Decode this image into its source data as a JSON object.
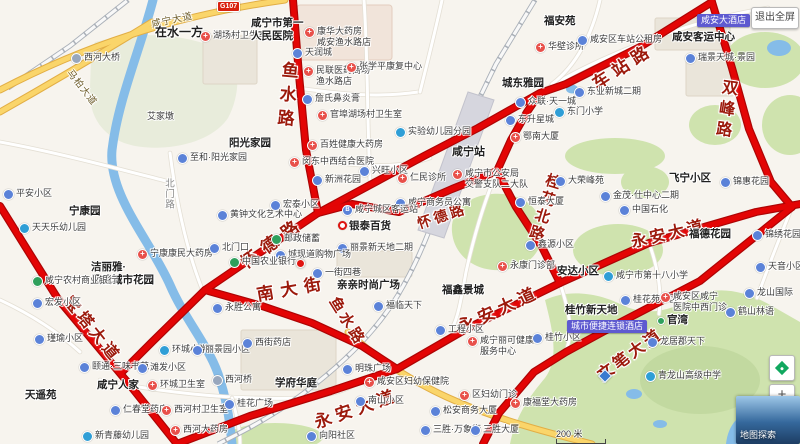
{
  "palette": {
    "route_red": "#e30505",
    "route_edge": "#ad0404",
    "water": "#85bce8",
    "green": "#cfe3ae",
    "road_yellow": "#fad56a",
    "red_label": "#9c1a0c",
    "ad_purple": "#5e5ad0"
  },
  "ui": {
    "fullscreen": "退出全屏",
    "zoom_in": "+",
    "zoom_out": "−",
    "explore": "地图探索",
    "scale": "200 米"
  },
  "map": {
    "shield": "G107",
    "red_roads": [
      {
        "t": "鱼水路",
        "x": 286,
        "y": 97,
        "v": 1,
        "rot": 5,
        "size": 17,
        "sp": 7
      },
      {
        "t": "车站路",
        "x": 622,
        "y": 65,
        "v": 0,
        "rot": -33,
        "size": 17,
        "sp": 6
      },
      {
        "t": "双峰路",
        "x": 724,
        "y": 110,
        "v": 1,
        "rot": 8,
        "size": 16,
        "sp": 5
      },
      {
        "t": "怀德路",
        "x": 272,
        "y": 241,
        "v": 0,
        "rot": -36,
        "size": 17,
        "sp": 8
      },
      {
        "t": "怀德路",
        "x": 442,
        "y": 216,
        "v": 0,
        "rot": -18,
        "size": 14,
        "sp": 3
      },
      {
        "t": "桂花北路",
        "x": 544,
        "y": 208,
        "v": 1,
        "rot": 17,
        "size": 15,
        "sp": 3
      },
      {
        "t": "南大街",
        "x": 292,
        "y": 287,
        "v": 0,
        "rot": -10,
        "size": 17,
        "sp": 7
      },
      {
        "t": "鱼水路",
        "x": 348,
        "y": 321,
        "v": 0,
        "rot": 58,
        "size": 15,
        "sp": 3
      },
      {
        "t": "永安大道",
        "x": 498,
        "y": 308,
        "v": 0,
        "rot": -25,
        "size": 17,
        "sp": 5
      },
      {
        "t": "永安大道",
        "x": 668,
        "y": 232,
        "v": 0,
        "rot": -13,
        "size": 16,
        "sp": 3
      },
      {
        "t": "永安大道",
        "x": 356,
        "y": 407,
        "v": 0,
        "rot": -19,
        "size": 17,
        "sp": 5
      },
      {
        "t": "宝塔大道",
        "x": 94,
        "y": 328,
        "v": 0,
        "rot": 51,
        "size": 16,
        "sp": 4
      },
      {
        "t": "文笔大道",
        "x": 629,
        "y": 353,
        "v": 0,
        "rot": -36,
        "size": 16,
        "sp": 3
      }
    ],
    "minor_road_labels": [
      {
        "t": "咸宁大道",
        "x": 172,
        "y": 19,
        "v": 0,
        "rot": -12,
        "size": 9.5,
        "c": "yl"
      },
      {
        "t": "马柏大道",
        "x": 83,
        "y": 87,
        "v": 0,
        "rot": 52,
        "size": 9.5,
        "c": "yl"
      },
      {
        "t": "北门路",
        "x": 168,
        "y": 194,
        "v": 1,
        "rot": 0,
        "size": 9.5,
        "c": "gy"
      }
    ],
    "ads": [
      {
        "t": "咸安大酒店",
        "x": 697,
        "y": 14
      },
      {
        "t": "城市便捷连锁酒店",
        "x": 567,
        "y": 320
      }
    ],
    "markers": [
      {
        "k": "red-pin",
        "x": 296,
        "y": 259
      },
      {
        "k": "blue-diamond",
        "x": 600,
        "y": 371
      }
    ],
    "pois": [
      {
        "t": "在水一方",
        "x": 155,
        "y": 25,
        "b": 1,
        "s": 12
      },
      {
        "t": "湖场村卫生室",
        "x": 200,
        "y": 30,
        "i": "med"
      },
      {
        "t": [
          "咸宁市第一",
          "人民医院"
        ],
        "x": 251,
        "y": 17,
        "b": 1
      },
      {
        "t": [
          "康华大药房",
          "咸安渔水路店"
        ],
        "x": 304,
        "y": 26,
        "i": "med"
      },
      {
        "t": "天润城",
        "x": 292,
        "y": 47,
        "i": "gen"
      },
      {
        "t": [
          "民联医药商场",
          "渔水路店"
        ],
        "x": 303,
        "y": 65,
        "i": "med"
      },
      {
        "t": "张学平康复中心",
        "x": 346,
        "y": 61,
        "i": "med"
      },
      {
        "t": "詹氏鼻炎膏",
        "x": 302,
        "y": 93,
        "i": "gen"
      },
      {
        "t": "官埠湖场村卫生室",
        "x": 317,
        "y": 109,
        "i": "med"
      },
      {
        "t": "实验幼儿园分园",
        "x": 395,
        "y": 126,
        "i": "school"
      },
      {
        "t": "百姓健康大药房",
        "x": 307,
        "y": 139,
        "i": "med"
      },
      {
        "t": "闵东中西结合医院",
        "x": 289,
        "y": 156,
        "i": "med"
      },
      {
        "t": "兴旺小区",
        "x": 359,
        "y": 165,
        "i": "gen"
      },
      {
        "t": "新洲花园",
        "x": 312,
        "y": 174,
        "i": "gen"
      },
      {
        "t": "至和·阳光家园",
        "x": 177,
        "y": 152,
        "i": "gen"
      },
      {
        "t": "阳光家园",
        "x": 229,
        "y": 137,
        "b": 1
      },
      {
        "t": "艾家墩",
        "x": 147,
        "y": 111
      },
      {
        "t": "西河大桥",
        "x": 71,
        "y": 52,
        "i": "bridge"
      },
      {
        "t": "平安小区",
        "x": 3,
        "y": 188,
        "i": "gen"
      },
      {
        "t": "天天乐幼儿园",
        "x": 19,
        "y": 222,
        "i": "school"
      },
      {
        "t": "宁康园",
        "x": 69,
        "y": 205,
        "b": 1
      },
      {
        "t": "宁康康民大药房",
        "x": 137,
        "y": 248,
        "i": "med"
      },
      {
        "t": [
          "洁丽雅·",
          "凤凰城市花园"
        ],
        "x": 91,
        "y": 261,
        "b": 1
      },
      {
        "t": "咸宁农村商业银行",
        "x": 32,
        "y": 275,
        "i": "bank"
      },
      {
        "t": "宏发小区",
        "x": 32,
        "y": 297,
        "i": "gen"
      },
      {
        "t": "瑾瑜小区",
        "x": 34,
        "y": 333,
        "i": "gen"
      },
      {
        "t": "天遥苑",
        "x": 25,
        "y": 389,
        "b": 1
      },
      {
        "t": "咸宁人家",
        "x": 97,
        "y": 379,
        "b": 1
      },
      {
        "t": "颐通·三味书苑",
        "x": 79,
        "y": 361,
        "i": "gen"
      },
      {
        "t": "滩发小区",
        "x": 137,
        "y": 362,
        "i": "gen"
      },
      {
        "t": "环城小学",
        "x": 159,
        "y": 344,
        "i": "school"
      },
      {
        "t": "环城卫生室",
        "x": 147,
        "y": 379,
        "i": "med"
      },
      {
        "t": "丽景园小区",
        "x": 192,
        "y": 344,
        "i": "gen"
      },
      {
        "t": "仁春堂药店",
        "x": 110,
        "y": 404,
        "i": "gen"
      },
      {
        "t": "西河村卫生室",
        "x": 161,
        "y": 404,
        "i": "med"
      },
      {
        "t": "西河大药房",
        "x": 170,
        "y": 424,
        "i": "med"
      },
      {
        "t": "西河桥",
        "x": 212,
        "y": 374,
        "i": "bridge"
      },
      {
        "t": "桂花广场",
        "x": 224,
        "y": 398,
        "i": "gen"
      },
      {
        "t": "学府华庭",
        "x": 275,
        "y": 377,
        "b": 1
      },
      {
        "t": "新青藤幼儿园",
        "x": 82,
        "y": 430,
        "i": "school"
      },
      {
        "t": "向阳社区",
        "x": 306,
        "y": 430,
        "i": "gen"
      },
      {
        "t": "西街药店",
        "x": 242,
        "y": 337,
        "i": "gen"
      },
      {
        "t": "永胜公寓",
        "x": 212,
        "y": 302,
        "i": "gen"
      },
      {
        "t": "明珠广场",
        "x": 342,
        "y": 363,
        "i": "gen"
      },
      {
        "t": "南山小区",
        "x": 355,
        "y": 395,
        "i": "gen"
      },
      {
        "t": "咸安区妇幼保健院",
        "x": 364,
        "y": 376,
        "i": "med"
      },
      {
        "t": "区妇幼门诊",
        "x": 459,
        "y": 389,
        "i": "med"
      },
      {
        "t": "松安商务大厦",
        "x": 430,
        "y": 405,
        "i": "gen"
      },
      {
        "t": "三胜·万象街",
        "x": 420,
        "y": 424,
        "i": "gen"
      },
      {
        "t": "三胜大厦",
        "x": 470,
        "y": 424,
        "i": "gen"
      },
      {
        "t": "康福堂大药房",
        "x": 510,
        "y": 397,
        "i": "med"
      },
      {
        "t": [
          "咸宁丽可健康",
          "服务中心"
        ],
        "x": 467,
        "y": 335,
        "i": "med"
      },
      {
        "t": "工程小区",
        "x": 435,
        "y": 324,
        "i": "gen"
      },
      {
        "t": "福鑫景城",
        "x": 442,
        "y": 284,
        "b": 1
      },
      {
        "t": "福临天下",
        "x": 373,
        "y": 300,
        "i": "gen"
      },
      {
        "t": "永康门诊部",
        "x": 497,
        "y": 260,
        "i": "med"
      },
      {
        "t": "安达小区",
        "x": 557,
        "y": 265,
        "b": 1
      },
      {
        "t": "桂竹小区",
        "x": 532,
        "y": 332,
        "i": "gen"
      },
      {
        "t": "桂竹新天地",
        "x": 565,
        "y": 304,
        "b": 1
      },
      {
        "t": "咸宁市第十八小学",
        "x": 603,
        "y": 270,
        "i": "school"
      },
      {
        "t": "金茂·仕中心二期",
        "x": 600,
        "y": 190,
        "i": "gen"
      },
      {
        "t": "中国石化",
        "x": 619,
        "y": 204,
        "i": "gen"
      },
      {
        "t": "大荣峰苑",
        "x": 555,
        "y": 175,
        "i": "gen"
      },
      {
        "t": "鑫源小区",
        "x": 525,
        "y": 239,
        "i": "gen"
      },
      {
        "t": "鄂南大厦",
        "x": 510,
        "y": 131,
        "i": "med"
      },
      {
        "t": "恒泰大厦",
        "x": 515,
        "y": 196,
        "i": "gen"
      },
      {
        "t": "东升星城",
        "x": 505,
        "y": 114,
        "i": "gen"
      },
      {
        "t": "东门小学",
        "x": 554,
        "y": 106,
        "i": "school"
      },
      {
        "t": "众联·天一城",
        "x": 515,
        "y": 96,
        "i": "gen"
      },
      {
        "t": "城东雅园",
        "x": 502,
        "y": 77,
        "b": 1
      },
      {
        "t": "东业新城二期",
        "x": 574,
        "y": 86,
        "i": "gen"
      },
      {
        "t": "福安苑",
        "x": 544,
        "y": 15,
        "b": 1
      },
      {
        "t": "华壁诊所",
        "x": 535,
        "y": 41,
        "i": "med"
      },
      {
        "t": "咸安区车站公租房",
        "x": 577,
        "y": 34,
        "i": "gen"
      },
      {
        "t": "咸安客运中心",
        "x": 672,
        "y": 31,
        "b": 1
      },
      {
        "t": "瑞景天城·景园",
        "x": 685,
        "y": 52,
        "i": "gen"
      },
      {
        "t": "飞宁小区",
        "x": 669,
        "y": 172,
        "b": 1
      },
      {
        "t": "锦惠花园",
        "x": 720,
        "y": 176,
        "i": "gen"
      },
      {
        "t": "福德花园",
        "x": 689,
        "y": 228,
        "b": 1
      },
      {
        "t": "锦绣花园",
        "x": 752,
        "y": 229,
        "i": "gen"
      },
      {
        "t": "天音小区",
        "x": 755,
        "y": 261,
        "i": "gen"
      },
      {
        "t": "桂花苑小区",
        "x": 620,
        "y": 294,
        "i": "gen"
      },
      {
        "t": [
          "咸安区咸宁",
          "医院中西门诊"
        ],
        "x": 660,
        "y": 291,
        "i": "med"
      },
      {
        "t": "龙山国际",
        "x": 744,
        "y": 287,
        "i": "gen"
      },
      {
        "t": "鹤山林语",
        "x": 725,
        "y": 306,
        "i": "gen"
      },
      {
        "t": "官湾",
        "x": 657,
        "y": 314,
        "b": 1,
        "i": "dot"
      },
      {
        "t": "龙居郡天下",
        "x": 647,
        "y": 336,
        "i": "gen"
      },
      {
        "t": "青龙山高级中学",
        "x": 645,
        "y": 370,
        "i": "school"
      },
      {
        "t": "咸宁站",
        "x": 452,
        "y": 146,
        "b": 1,
        "s": 11
      },
      {
        "t": [
          "咸宁市公安局",
          "交警支队二大队"
        ],
        "x": 452,
        "y": 168,
        "i": "med"
      },
      {
        "t": "仁民诊所",
        "x": 397,
        "y": 172,
        "i": "med"
      },
      {
        "t": "咸宁商务员公寓",
        "x": 395,
        "y": 197,
        "i": "gen"
      },
      {
        "t": "咸宁城区客运站",
        "x": 342,
        "y": 204,
        "i": "bus"
      },
      {
        "t": "银泰百货",
        "x": 338,
        "y": 220,
        "b": 1,
        "i": "ring"
      },
      {
        "t": "丽景新天地二期",
        "x": 337,
        "y": 242,
        "i": "gen"
      },
      {
        "t": "城现道购物广场",
        "x": 275,
        "y": 249,
        "i": "gen"
      },
      {
        "t": "邮政储蓄",
        "x": 271,
        "y": 233,
        "i": "bank"
      },
      {
        "t": "北门口",
        "x": 209,
        "y": 242,
        "i": "gen"
      },
      {
        "t": "中国农业银行",
        "x": 229,
        "y": 256,
        "i": "bank"
      },
      {
        "t": "黄钟文化艺术中心",
        "x": 217,
        "y": 209,
        "i": "gen"
      },
      {
        "t": "宏泰小区",
        "x": 270,
        "y": 199,
        "i": "gen"
      },
      {
        "t": "亲亲时尚广场",
        "x": 337,
        "y": 279,
        "b": 1
      },
      {
        "t": "一街四巷",
        "x": 312,
        "y": 267,
        "i": "gen"
      }
    ]
  }
}
